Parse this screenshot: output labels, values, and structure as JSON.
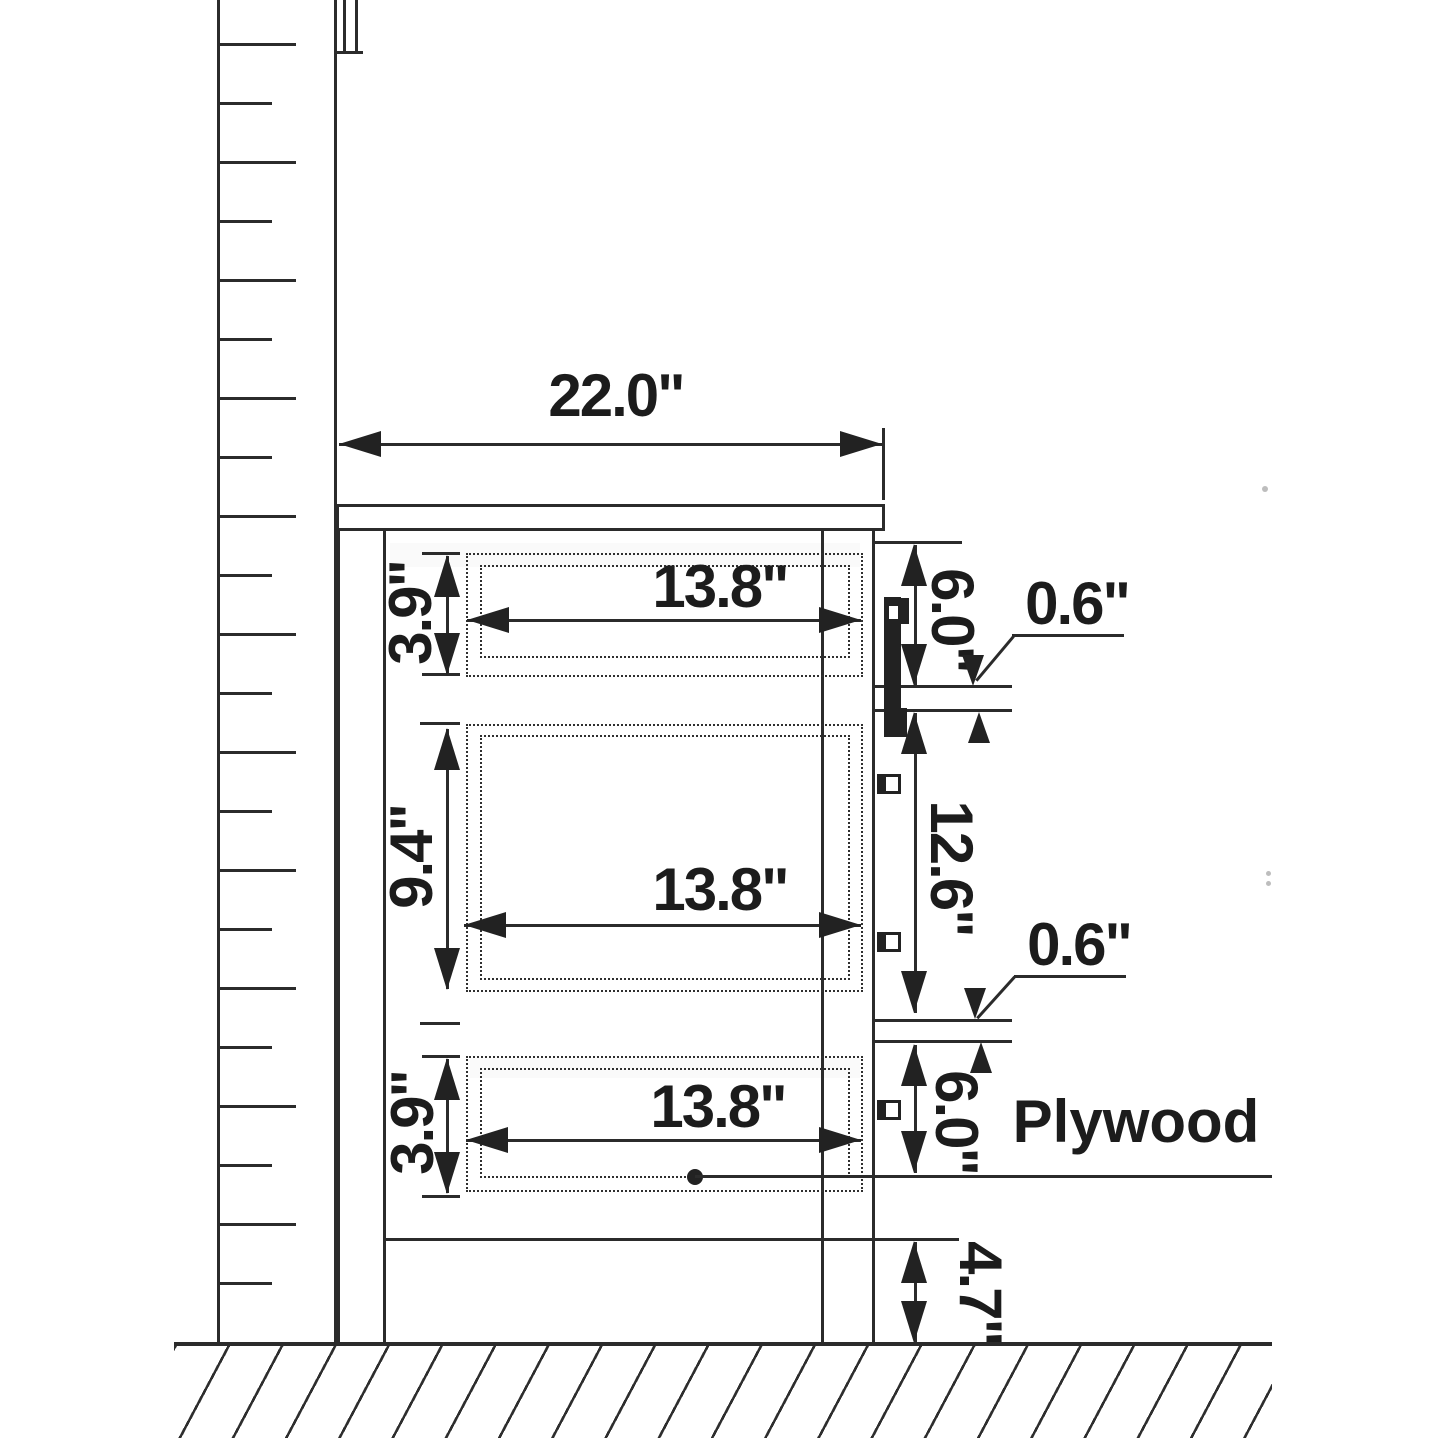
{
  "drawing": {
    "type": "cabinet-side-section-technical-drawing",
    "subject": "Vanity cabinet side view with three drawers, wall and floor section"
  },
  "colors": {
    "line": "#2b2b2b",
    "text": "#1c1c1c",
    "background": "#ffffff"
  },
  "dimensions": {
    "overall_depth": "22.0\"",
    "drawer_top": {
      "width": "13.8\"",
      "height": "3.9\""
    },
    "drawer_middle": {
      "width": "13.8\"",
      "height": "9.4\""
    },
    "drawer_bottom": {
      "width": "13.8\"",
      "height": "3.9\""
    },
    "right_side": {
      "top_section": "6.0\"",
      "middle_section": "12.6\"",
      "bottom_section": "6.0\"",
      "shelf_thickness_upper": "0.6\"",
      "shelf_thickness_lower": "0.6\"",
      "toe_kick": "4.7\""
    }
  },
  "labels": {
    "plywood": "Plywood"
  }
}
